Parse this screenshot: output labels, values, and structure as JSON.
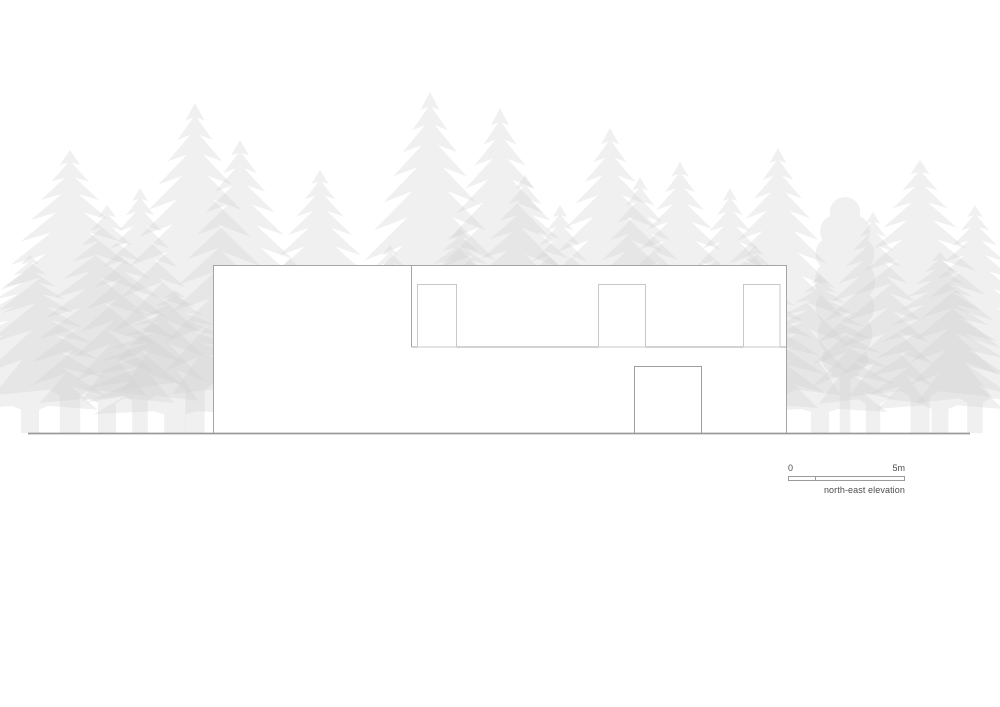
{
  "drawing": {
    "caption": "north-east elevation",
    "scale_bar": {
      "start_label": "0",
      "end_label": "5m"
    }
  },
  "colors": {
    "background": "#ffffff",
    "building_outline": "#a5a5a5",
    "step_line": "#a5a5a5",
    "window_outline": "#c8c8c8",
    "door_outline": "#9e9e9e",
    "ground_line": "#9b9b9b",
    "scale_bar_border": "#9b9b9b",
    "label_text": "#4d4d4d",
    "tree_base": "#cfcfcf"
  }
}
